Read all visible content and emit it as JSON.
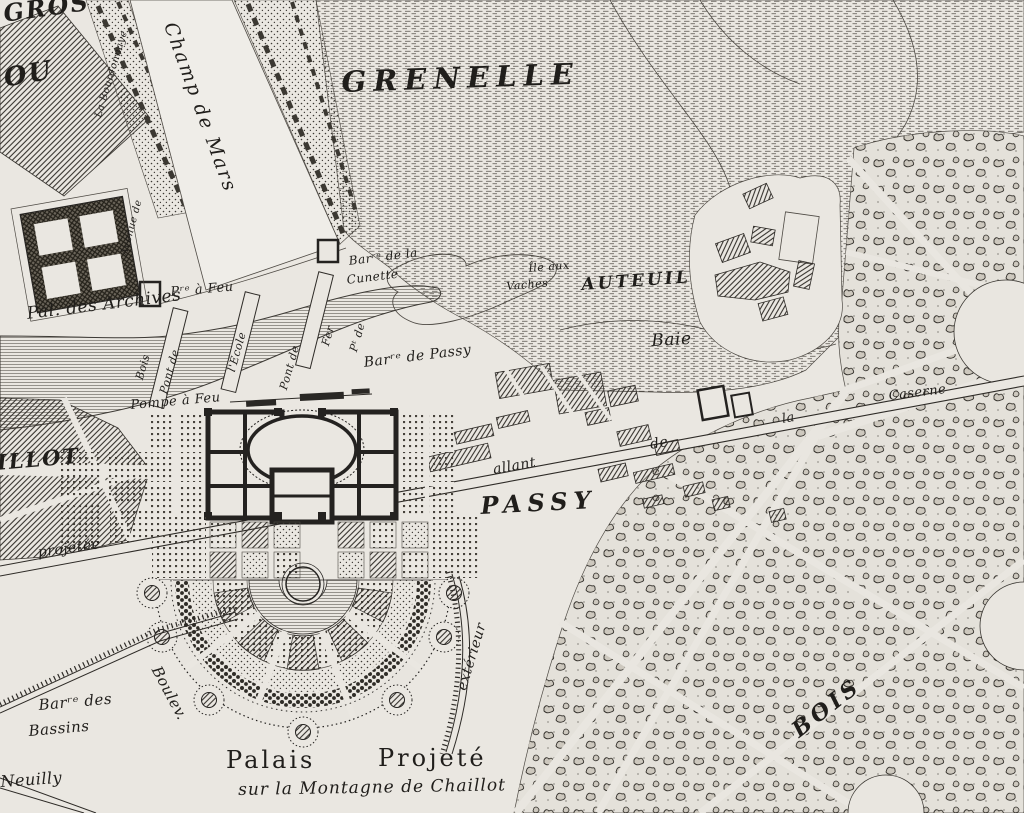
{
  "map": {
    "type": "historic-engraved-plan",
    "colors": {
      "paper": "#eae7e1",
      "ink": "#242220",
      "line": "#4e4a44"
    },
    "labels": {
      "gros": "GROS",
      "ou": "OU",
      "champ_de_mars": "Champ de Mars",
      "grenelle": "GRENELLE",
      "avenue_de": "Avenue de",
      "la_bourdonnaye": "La Bourdonnaye",
      "pal_des_archives": "Pal. des Archives",
      "pre_a_feu": "Pʳᵉ à Feu",
      "barre_de_la": "Barʳᵉ de la",
      "cunette": "Cunette",
      "ile_aux": "Île aux",
      "vaches": "Vaches",
      "auteuil": "AUTEUIL",
      "baie": "Baie",
      "bois_bridge": "Bois",
      "pont_de_1": "Pont de",
      "l_ecole": "l'École",
      "pont_de_2": "Pont de",
      "fer": "Fer",
      "pt_de": "Pᵗ de",
      "barre_de_passy": "Barʳᵉ de Passy",
      "pompe_a_feu": "Pompe à Feu",
      "chaillot_part": "ILLOT",
      "projetee": "projetée",
      "allant": "allant",
      "de": "de",
      "la": "la",
      "caserne": "Caserne",
      "passy": "PASSY",
      "barre_des": "Barʳᵉ des",
      "bassins": "Bassins",
      "boulev": "Boulev.",
      "exterieur": "extérieur",
      "neuilly": "Neuilly",
      "palais": "Palais",
      "projete": "Projeté",
      "sur_la_montagne": "sur la Montagne de Chaillot",
      "bois_caps": "BOIS"
    }
  }
}
